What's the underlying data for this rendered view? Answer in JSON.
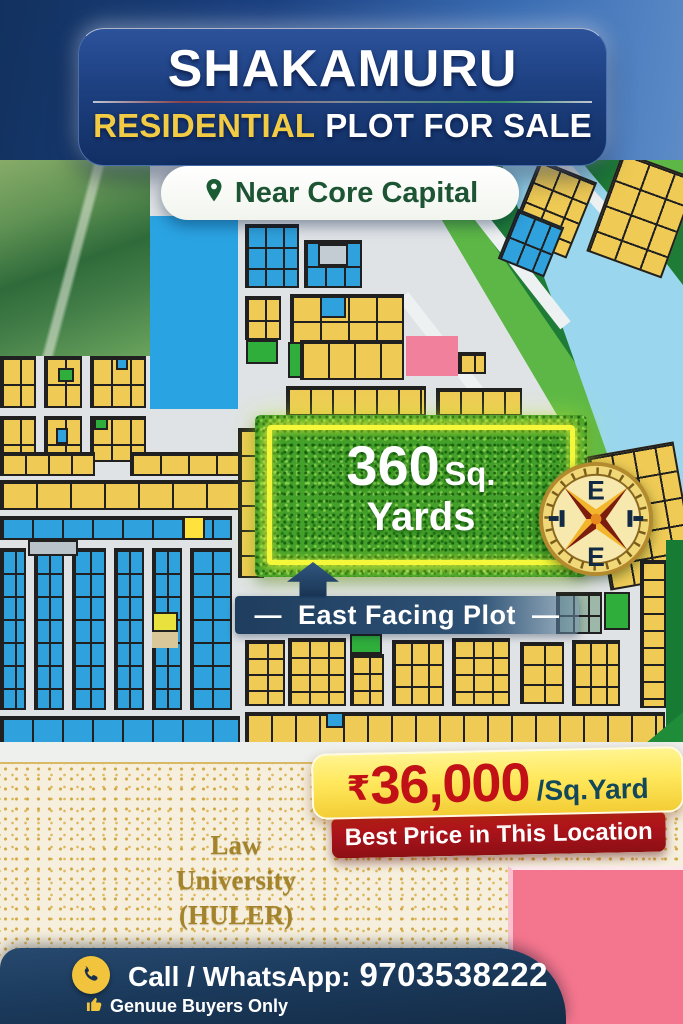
{
  "header": {
    "title": "SHAKAMURU",
    "subtitle_highlight": "RESIDENTIAL",
    "subtitle_rest": "PLOT FOR SALE",
    "location": "Near Core Capital"
  },
  "plot": {
    "area_value": "360",
    "area_unit": "Sq.",
    "area_unit_line2": "Yards",
    "facing_dash": "—",
    "facing_label": "East Facing Plot"
  },
  "compass": {
    "top": "E",
    "bottom": "E"
  },
  "price": {
    "currency": "₹",
    "amount": "36,000",
    "per_unit": "/Sq.Yard",
    "tagline": "Best Price in This Location"
  },
  "landmark": {
    "lines": [
      "Law",
      "University",
      "(HULER)"
    ]
  },
  "contact": {
    "label": "Call / WhatsApp:",
    "number": "9703538222",
    "note": "Genuue Buyers Only"
  },
  "icons": {
    "location_pin": "map-pin",
    "phone": "phone-handset",
    "thumbs_up": "thumbs-up",
    "compass": "compass-rose"
  },
  "colors": {
    "banner_navy": "#1b3a73",
    "subtitle_yellow": "#f2cb45",
    "pill_text_green": "#1d5434",
    "plot_yellow": "#efcb55",
    "plot_blue": "#2fa1dc",
    "plot_green": "#2fae3c",
    "plot_pink": "#f0809b",
    "river_blue": "#9ad7ee",
    "bank_green": "#1e7c36",
    "grass_green": "#43a02a",
    "neon_frame": "#f5f83a",
    "price_red": "#c11016",
    "price_unit_teal": "#12485a",
    "tagline_red": "#a3121a",
    "beige": "#f6efdd",
    "gold_text": "#a3842c",
    "bar_navy": "#16304d",
    "icon_gold": "#f2c43d"
  }
}
